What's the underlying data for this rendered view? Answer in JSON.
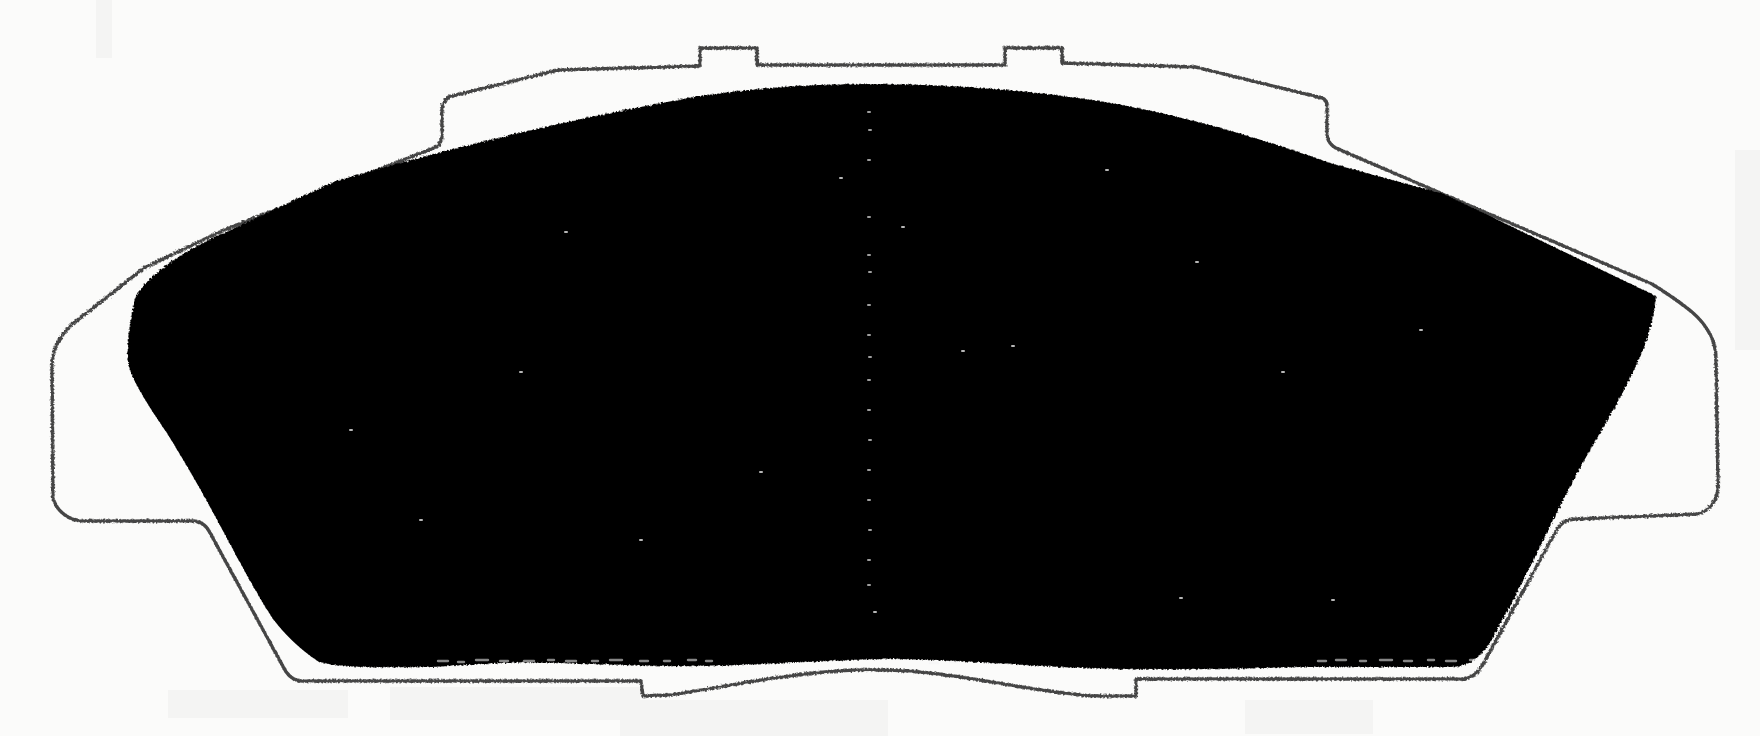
{
  "figure": {
    "kind": "scanned technical drawing",
    "subject": "Disc brake pad backing plate outline with solid friction material silhouette",
    "canvas": {
      "width": 1760,
      "height": 736
    }
  },
  "colors": {
    "background": "#fbfbfa",
    "outline": "#454545",
    "pad_fill": "#060606",
    "speckle": "#f4f4f4",
    "shade": "#e7e7e6"
  },
  "paths": {
    "backing_plate": "M700,66 L700,48 L757,48 L757,65 L1005,65 L1005,48 L1062,48 L1062,63 L1195,67 L1322,98 C1325,99 1327,102 1327,107 L1327,133 C1327,141 1331,146 1338,149 L1652,284 C1668,294 1681,303 1692,312 C1707,325 1716,341 1716,359 L1718,485 C1718,499 1711,510 1698,514 L1575,519 C1566,519 1560,524 1556,531 L1482,666 C1477,674 1470,679 1461,679 L1136,679 L1136,696 L1092,696 C1020,690 952,671 885,670 C812,668 742,684 670,695 L643,696 L641,681 L303,681 C295,681 289,677 285,670 L209,531 C205,524 199,521 192,521 L82,521 C70,521 56,511 53,498 L52,366 C52,349 61,333 75,322 L144,268 L224,230 L434,148 C439,146 442,141 442,135 L442,110 C442,103 446,98 452,96 L558,70 Z",
    "friction_material": "M136,296 C148,276 180,252 224,233 C260,216 300,197 336,181 C450,148 564,120 700,96 C762,87 816,84 872,84 C940,84 1012,89 1072,97 C1164,109 1254,136 1334,164 L1444,194 L1656,296 C1654,320 1646,346 1636,366 C1618,404 1601,431 1581,466 C1551,521 1521,590 1489,644 C1479,659 1468,667 1449,667 L1302,667 C1202,670 1152,670 1082,668 C1012,665 942,659 884,659 C812,661 762,665 702,666 C632,667 562,661 502,663 L432,667 C392,667 342,669 319,662 C301,650 286,636 273,619 C241,571 201,481 152,411 C140,391 130,376 128,361 C126,346 130,318 136,296 Z",
    "white_speckles": "M565,232h2 M840,178h2 M902,227h2 M1012,346h2 M962,351h2 M1106,170h2 M1196,262h2 M1282,372h2 M1332,600h2 M1180,598h2 M760,472h2 M520,372h2 M640,540h2 M1420,330h2 M874,612h2 M350,430h2 M420,520h2 M726,91h2 M444,141h0.5",
    "center_seam_dots": "M868,112h2 M869,130h2 M868,160h2 M868,217h2 M868,255h2 M869,272h2 M868,305h2 M868,335h2 M869,357h2 M868,380h2 M868,410h2 M869,440h2 M868,470h2 M868,500h2 M869,530h2 M868,560h2 M868,585h2",
    "bottom_edge_dashes": "M438,661h10 M458,662h6 M476,660h12 M500,661h8 M524,661h10 M548,660h6 M566,661h10 M592,661h6 M610,660h12 M640,661h8 M664,661h6 M688,660h8 M706,661h6 M930,663h8 M950,662h6 M1318,661h8 M1336,660h10 M1360,661h6 M1380,660h12 M1404,661h8 M1428,660h6 M1446,661h10 M1470,660h6",
    "paper_shading": "M390,687h250v33h-250Z M620,700h268v36h-268Z M1245,700h128v34h-128Z M168,690h180v28h-180Z M96,0h16v58h-16Z M1735,150h25v200h-25Z"
  }
}
